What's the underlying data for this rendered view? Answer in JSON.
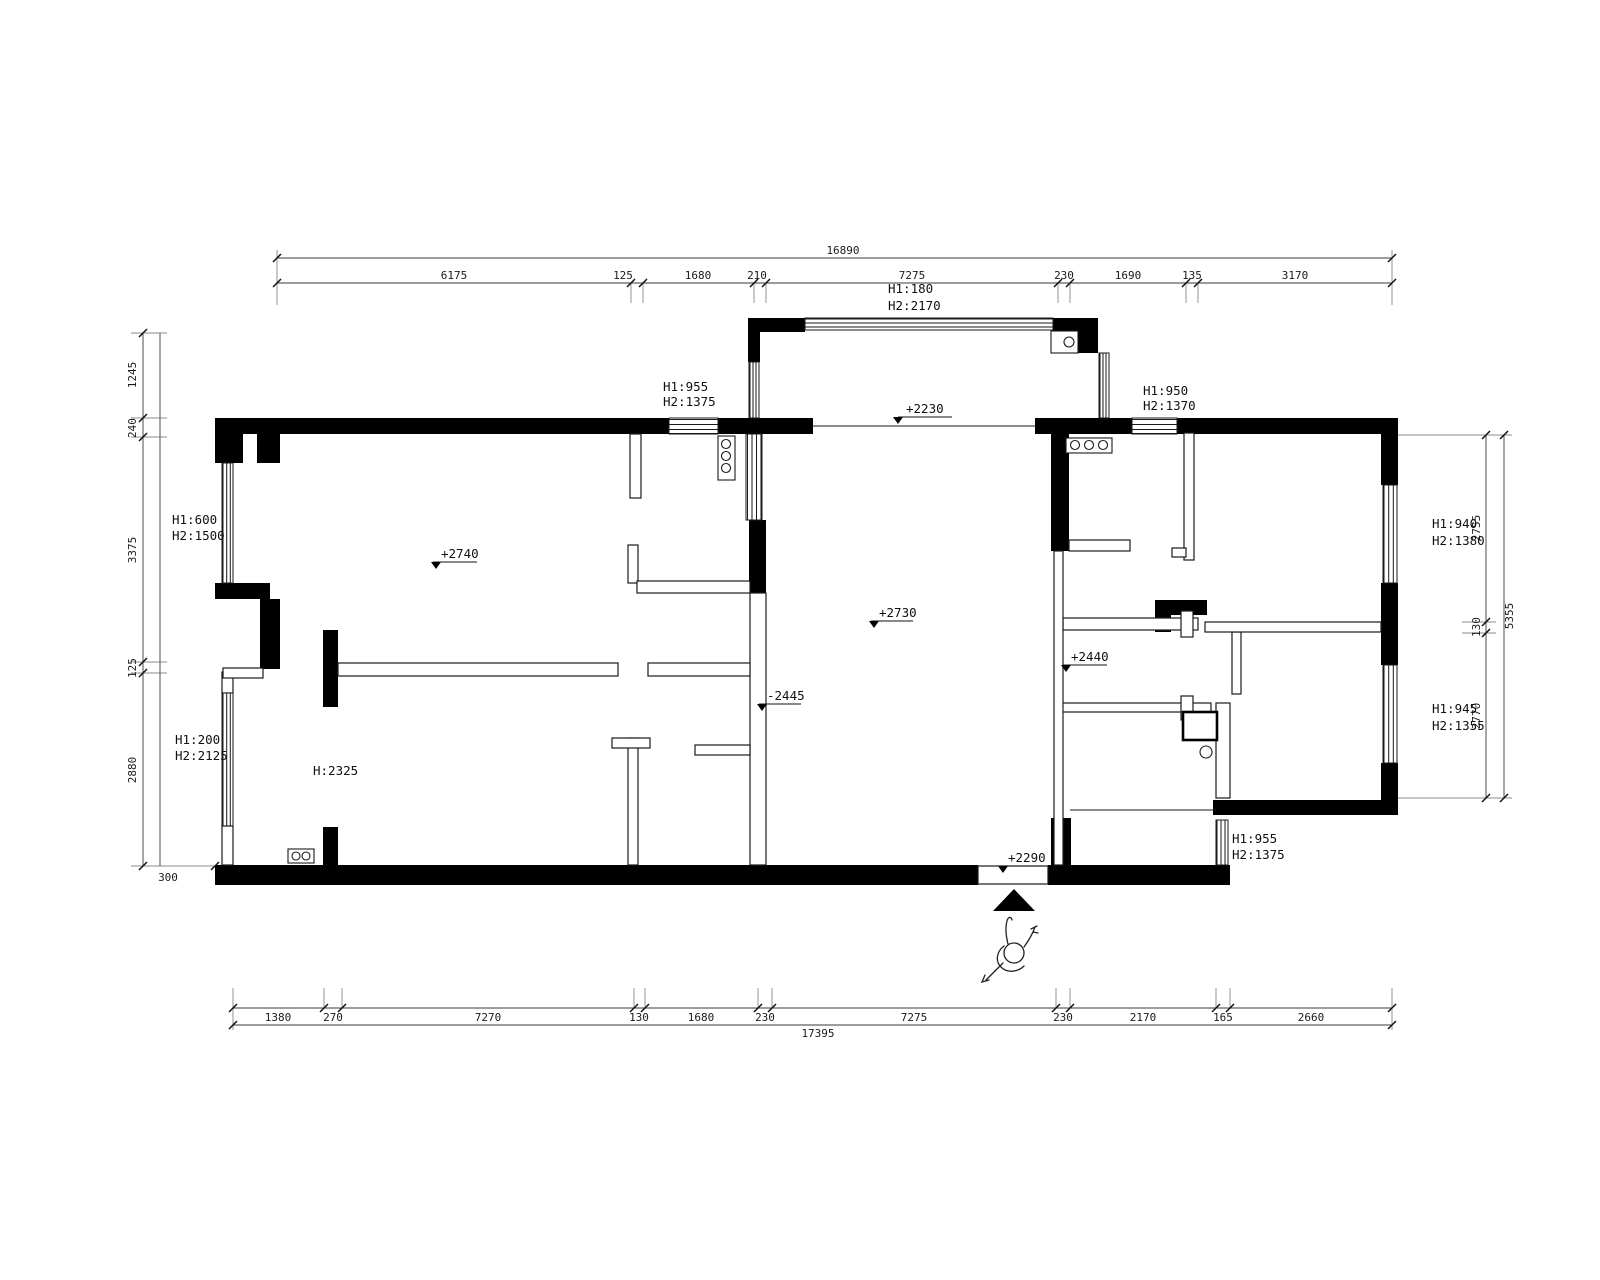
{
  "plan": {
    "dims": {
      "top": {
        "total": "16890",
        "segments": [
          "6175",
          "125",
          "1680",
          "210",
          "7275",
          "230",
          "1690",
          "135",
          "3170"
        ]
      },
      "bottom": {
        "total": "17395",
        "segments": [
          "1380",
          "270",
          "7270",
          "130",
          "1680",
          "230",
          "7275",
          "230",
          "2170",
          "165",
          "2660"
        ]
      },
      "left": {
        "segments": [
          "1245",
          "240",
          "3375",
          "125",
          "2880"
        ],
        "offset": "300"
      },
      "right": {
        "total": "5355",
        "segments": [
          "2755",
          "130",
          "2770"
        ]
      }
    },
    "levels": {
      "balcony": "+2230",
      "living": "+2740",
      "center": "+2730",
      "hallway": "+2440",
      "passage": "-2445",
      "entry": "+2290"
    },
    "heights": {
      "balcony_window": {
        "h1": "H1:180",
        "h2": "H2:2170"
      },
      "living_top_window": {
        "h1": "H1:955",
        "h2": "H2:1375"
      },
      "kitchen_top_window": {
        "h1": "H1:950",
        "h2": "H2:1370"
      },
      "living_left_window": {
        "h1": "H1:600",
        "h2": "H2:1500"
      },
      "bedroom_left_window": {
        "h1": "H1:200",
        "h2": "H2:2125"
      },
      "left_door": {
        "h": "H:2325"
      },
      "right_top_window": {
        "h1": "H1:940",
        "h2": "H2:1380"
      },
      "right_bottom_window": {
        "h1": "H1:945",
        "h2": "H2:1355"
      },
      "bath_window": {
        "h1": "H1:955",
        "h2": "H2:1375"
      }
    }
  }
}
